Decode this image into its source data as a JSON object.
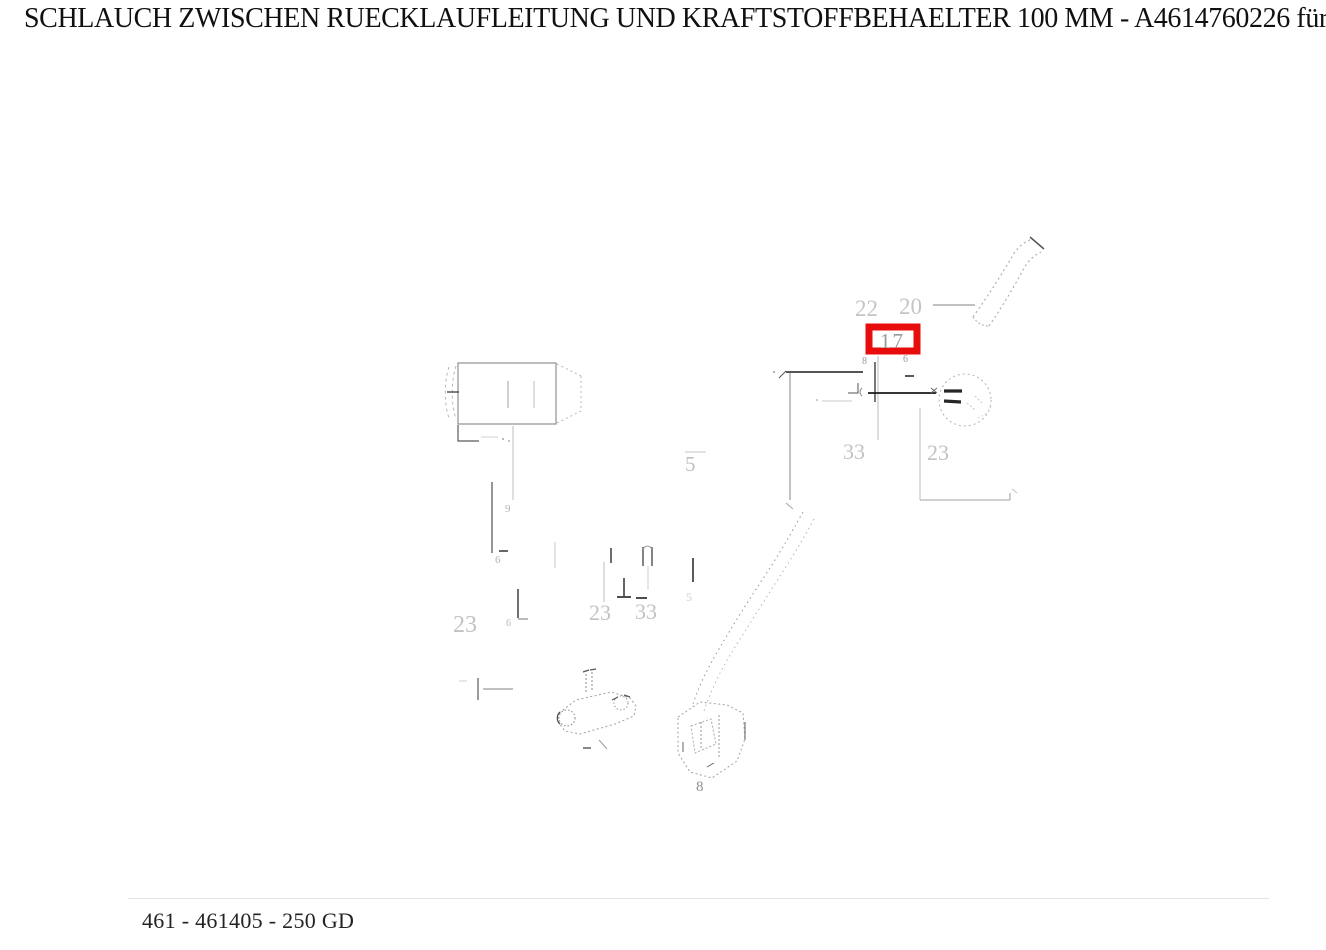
{
  "page": {
    "title": "SCHLAUCH ZWISCHEN RUECKLAUFLEITUNG UND KRAFTSTOFFBEHAELTER 100 MM - A4614760226 für 250 GD"
  },
  "footer": {
    "reference": "461 - 461405 - 250 GD"
  },
  "diagram": {
    "highlight_color": "#e80c0c",
    "highlighted_part": "17",
    "labels": {
      "n22": "22",
      "n20": "20",
      "n17": "17",
      "n33_right": "33",
      "n23_right": "23",
      "n5": "5",
      "n23_left": "23",
      "n23_mid": "23",
      "n33_mid": "33",
      "n8": "8",
      "n9": "9",
      "n6_left": "6",
      "n6_mid": "6",
      "n8_fitting": "8",
      "n6_fitting": "6",
      "n5_mid_small": "5"
    }
  }
}
